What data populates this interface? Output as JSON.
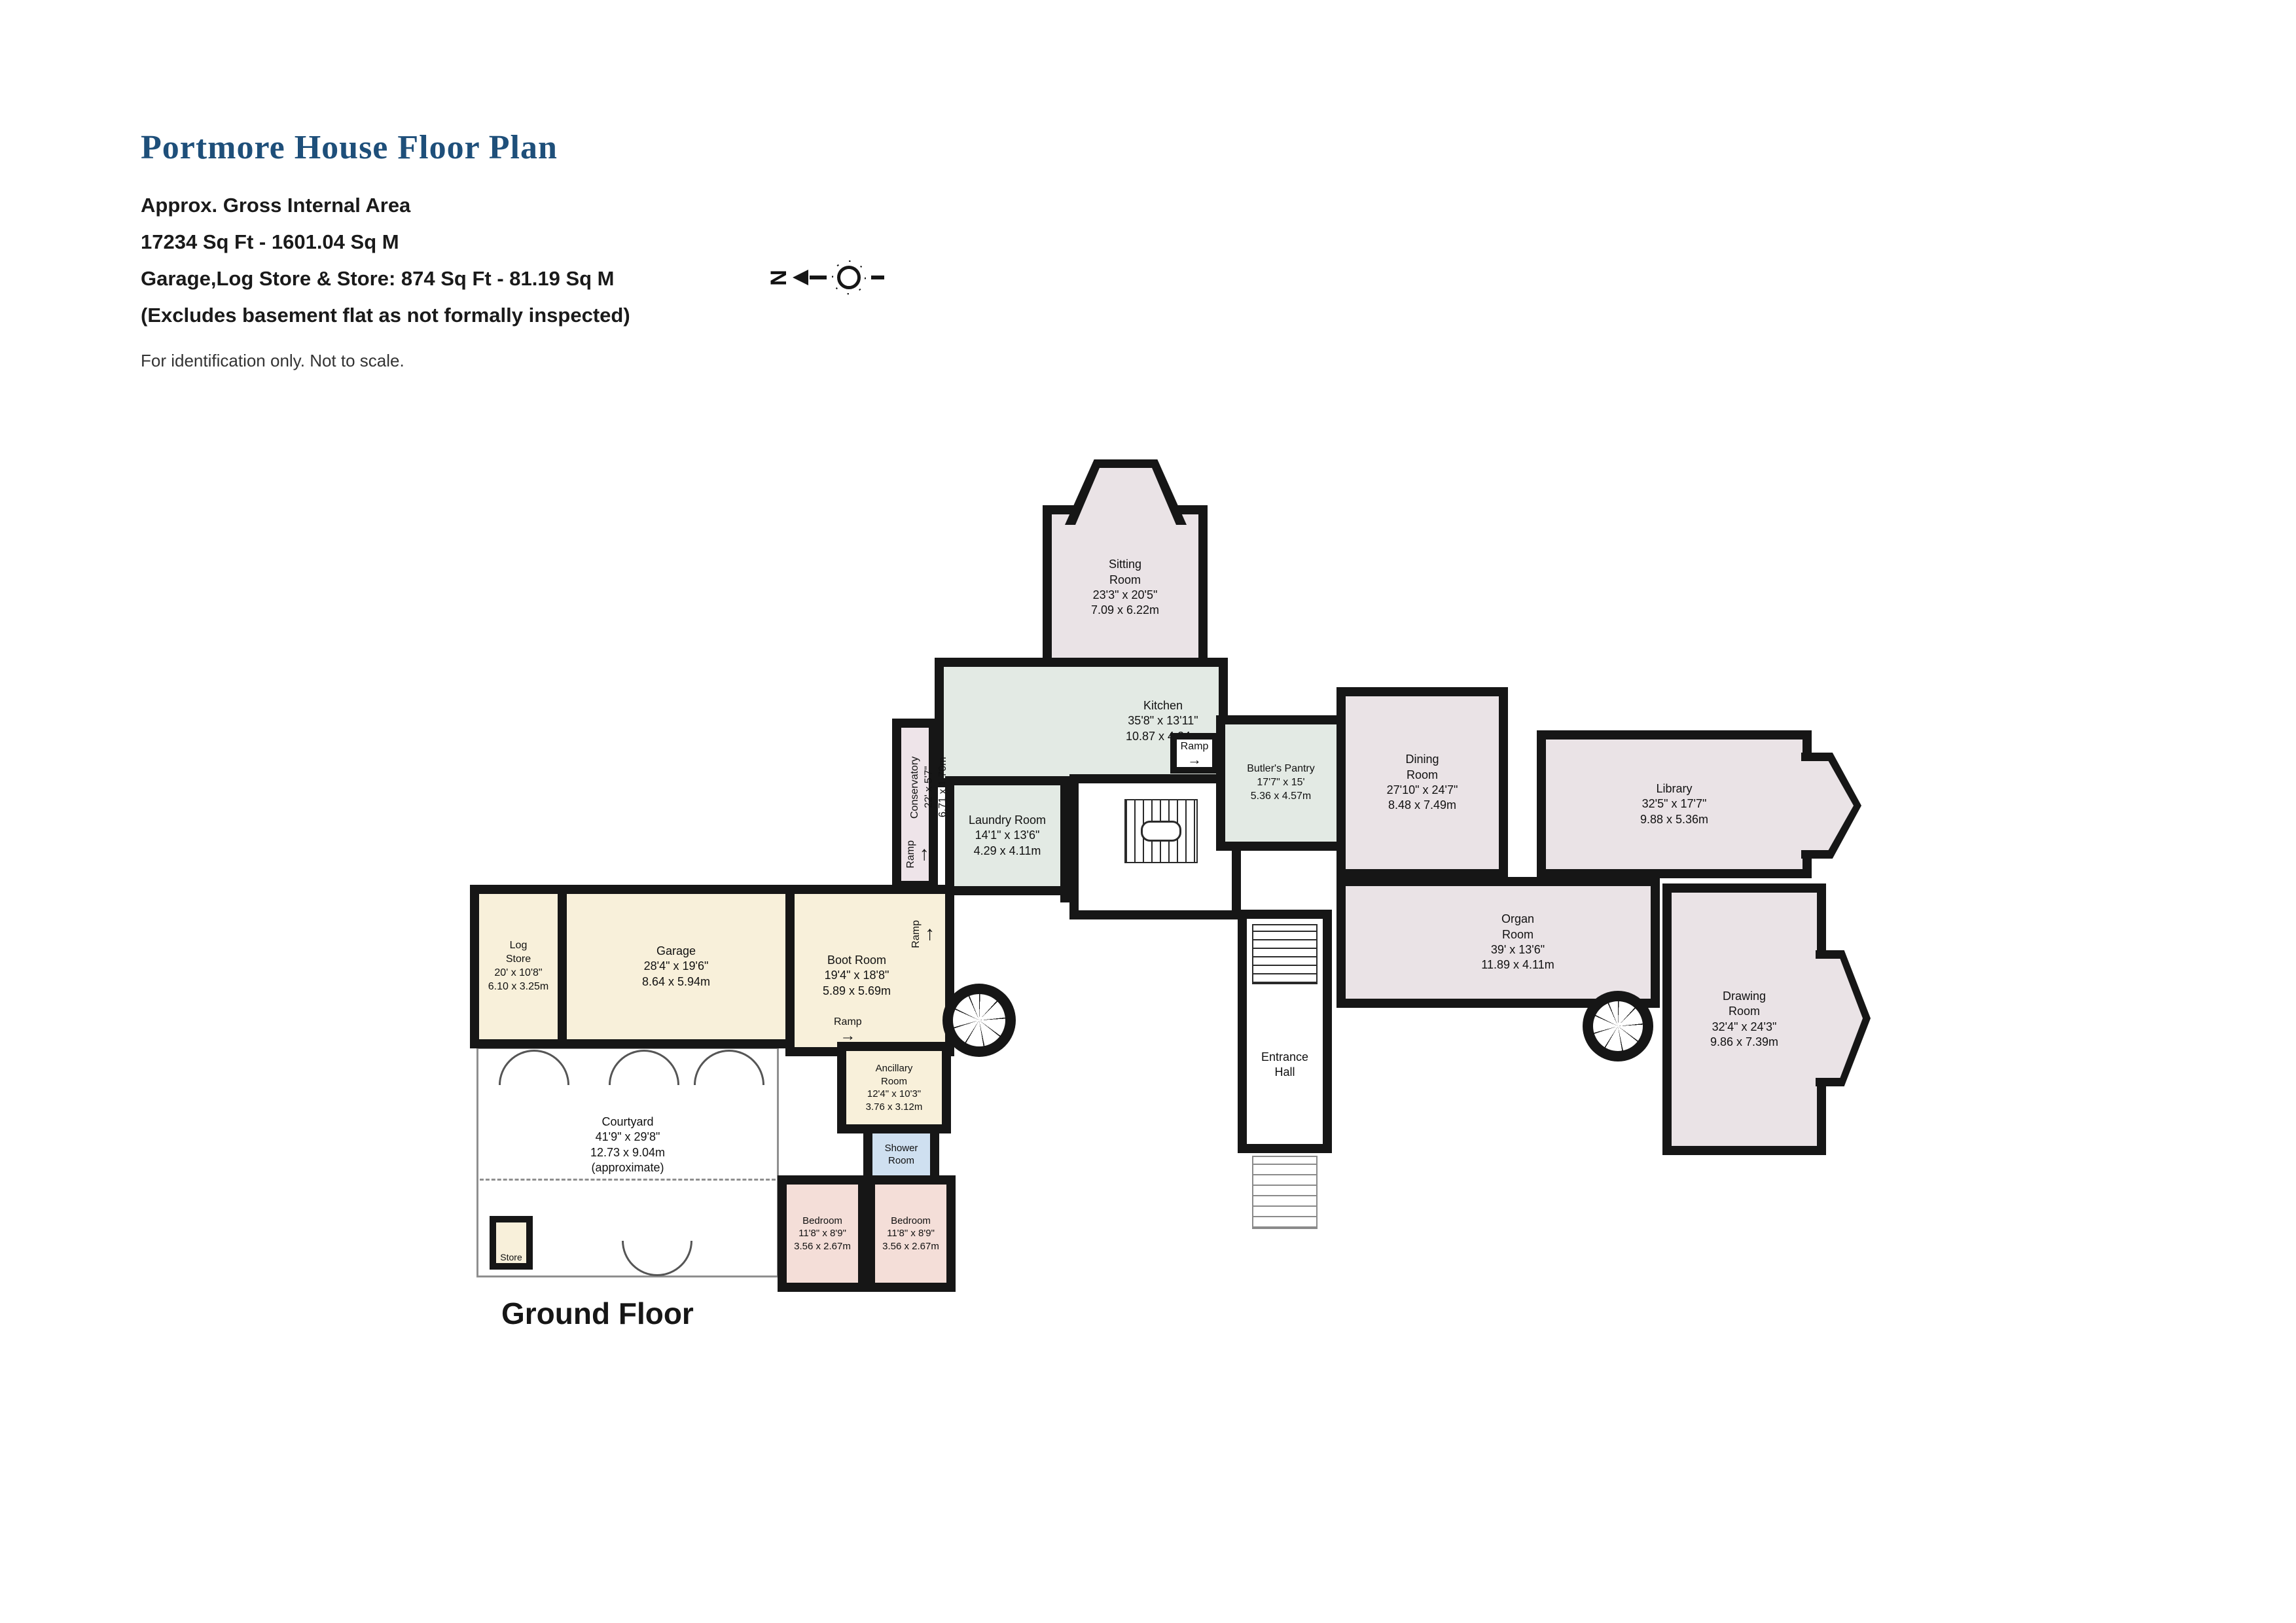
{
  "header": {
    "title": "Portmore House Floor Plan",
    "area_line1": "Approx. Gross Internal Area",
    "area_line2": "17234 Sq Ft - 1601.04 Sq M",
    "area_line3": "Garage,Log Store & Store: 874 Sq Ft - 81.19 Sq M",
    "area_line4": "(Excludes basement flat as not formally inspected)",
    "disclaimer": "For identification only. Not to scale.",
    "compass_letter": "N"
  },
  "floor_label": "Ground Floor",
  "colors": {
    "wall": "#161616",
    "room_pink": "#eae3e6",
    "room_green": "#e3eae4",
    "room_cream": "#f8f0da",
    "room_blue": "#cfe0f0",
    "room_bedroom": "#f4ded8",
    "title_blue": "#1e4f7a"
  },
  "rooms": {
    "sitting": {
      "label": "Sitting\nRoom\n23'3\" x 20'5\"\n7.09 x 6.22m"
    },
    "kitchen": {
      "label": "Kitchen\n35'8\" x 13'11\"\n10.87 x 4.24m"
    },
    "conservatory": {
      "label": "Conservatory\n22' x 5'7\"\n6.71 x 1.70m"
    },
    "laundry": {
      "label": "Laundry Room\n14'1\" x 13'6\"\n4.29 x 4.11m"
    },
    "wc": {
      "label": "WC"
    },
    "butlers_pantry": {
      "label": "Butler's Pantry\n17'7\" x 15'\n5.36 x 4.57m"
    },
    "dining": {
      "label": "Dining\nRoom\n27'10\" x 24'7\"\n8.48 x 7.49m"
    },
    "library": {
      "label": "Library\n32'5\" x 17'7\"\n9.88 x 5.36m"
    },
    "organ": {
      "label": "Organ\nRoom\n39' x 13'6\"\n11.89 x 4.11m"
    },
    "drawing": {
      "label": "Drawing\nRoom\n32'4\" x 24'3\"\n9.86 x 7.39m"
    },
    "entrance": {
      "label": "Entrance\nHall"
    },
    "log_store": {
      "label": "Log\nStore\n20' x 10'8\"\n6.10 x 3.25m"
    },
    "garage": {
      "label": "Garage\n28'4\" x 19'6\"\n8.64 x 5.94m"
    },
    "boot": {
      "label": "Boot Room\n19'4\" x 18'8\"\n5.89 x 5.69m"
    },
    "ancillary": {
      "label": "Ancillary\nRoom\n12'4\" x 10'3\"\n3.76 x 3.12m"
    },
    "shower": {
      "label": "Shower\nRoom"
    },
    "bedroom1": {
      "label": "Bedroom\n11'8\" x 8'9\"\n3.56 x 2.67m"
    },
    "bedroom2": {
      "label": "Bedroom\n11'8\" x 8'9\"\n3.56 x 2.67m"
    },
    "courtyard": {
      "label": "Courtyard\n41'9\" x 29'8\"\n12.73 x 9.04m\n(approximate)"
    },
    "store": {
      "label": "Store"
    }
  },
  "annotations": {
    "ramp": "Ramp",
    "arrow_up": "↑",
    "arrow_right": "→"
  }
}
